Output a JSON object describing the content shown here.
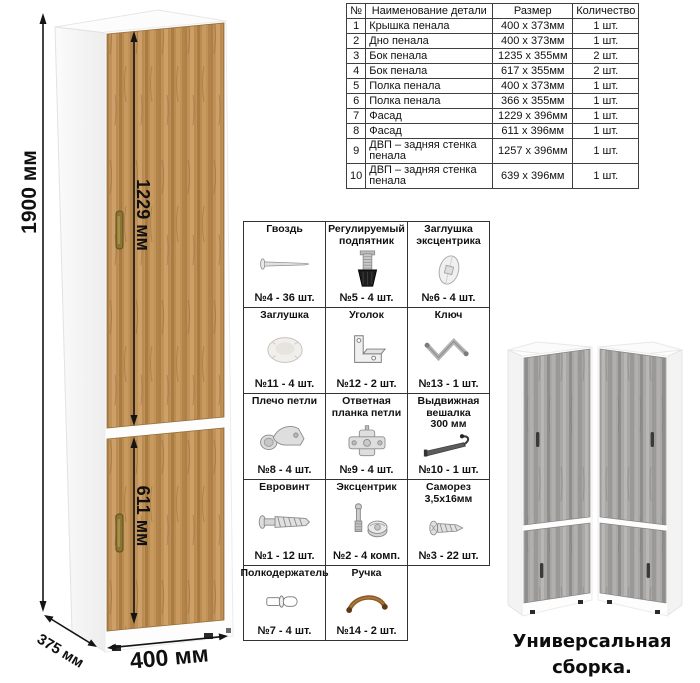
{
  "parts_table": {
    "headers": [
      "№",
      "Наименование детали",
      "Размер",
      "Количество"
    ],
    "rows": [
      [
        "1",
        "Крышка пенала",
        "400 x 373мм",
        "1 шт."
      ],
      [
        "2",
        "Дно пенала",
        "400 x 373мм",
        "1 шт."
      ],
      [
        "3",
        "Бок пенала",
        "1235 x 355мм",
        "2 шт."
      ],
      [
        "4",
        "Бок пенала",
        "617 x 355мм",
        "2 шт."
      ],
      [
        "5",
        "Полка пенала",
        "400 x 373мм",
        "1 шт."
      ],
      [
        "6",
        "Полка пенала",
        "366 x 355мм",
        "1 шт."
      ],
      [
        "7",
        "Фасад",
        "1229 x 396мм",
        "1 шт."
      ],
      [
        "8",
        "Фасад",
        "611 x 396мм",
        "1 шт."
      ],
      [
        "9",
        "ДВП – задняя стенка пенала",
        "1257 x 396мм",
        "1 шт."
      ],
      [
        "10",
        "ДВП – задняя стенка пенала",
        "639 x 396мм",
        "1 шт."
      ]
    ]
  },
  "hardware": {
    "items": [
      {
        "name": "Гвоздь",
        "qty": "№4 - 36 шт.",
        "icon": "nail-icon"
      },
      {
        "name": "Регулируемый подпятник",
        "qty": "№5 - 4 шт.",
        "icon": "adjustable-foot-icon"
      },
      {
        "name": "Заглушка эксцентрика",
        "qty": "№6 - 4 шт.",
        "icon": "cam-cap-icon"
      },
      {
        "name": "Заглушка",
        "qty": "№11 - 4 шт.",
        "icon": "cap-icon"
      },
      {
        "name": "Уголок",
        "qty": "№12 - 2 шт.",
        "icon": "corner-bracket-icon"
      },
      {
        "name": "Ключ",
        "qty": "№13 - 1 шт.",
        "icon": "hex-key-icon"
      },
      {
        "name": "Плечо петли",
        "qty": "№8 - 4 шт.",
        "icon": "hinge-arm-icon"
      },
      {
        "name": "Ответная планка петли",
        "qty": "№9 - 4 шт.",
        "icon": "hinge-plate-icon"
      },
      {
        "name": "Выдвижная вешалка 300 мм",
        "qty": "№10 - 1 шт.",
        "icon": "pullout-hanger-icon"
      },
      {
        "name": "Евровинт",
        "qty": "№1 - 12 шт.",
        "icon": "euro-screw-icon"
      },
      {
        "name": "Эксцентрик",
        "qty": "№2 - 4 комп.",
        "icon": "cam-lock-icon"
      },
      {
        "name": "Саморез 3,5x16мм",
        "qty": "№3 - 22 шт.",
        "icon": "self-tapping-screw-icon"
      },
      {
        "name": "Полкодержатель",
        "qty": "№7 - 4 шт.",
        "icon": "shelf-pin-icon"
      },
      {
        "name": "Ручка",
        "qty": "№14 - 2 шт.",
        "icon": "handle-icon"
      }
    ]
  },
  "dimensions": {
    "height": "1900 мм",
    "upper_door": "1229 мм",
    "lower_door": "611 мм",
    "width": "400 мм",
    "depth": "375 мм"
  },
  "caption": "Универсальная сборка.",
  "colors": {
    "wood": "#c09257",
    "wood_dark": "#a87c45",
    "gray_wood": "#a9a8a6",
    "carcass_white": "#fbfbfb",
    "handle_bronze": "#8a7434",
    "dimension_black": "#101010"
  }
}
